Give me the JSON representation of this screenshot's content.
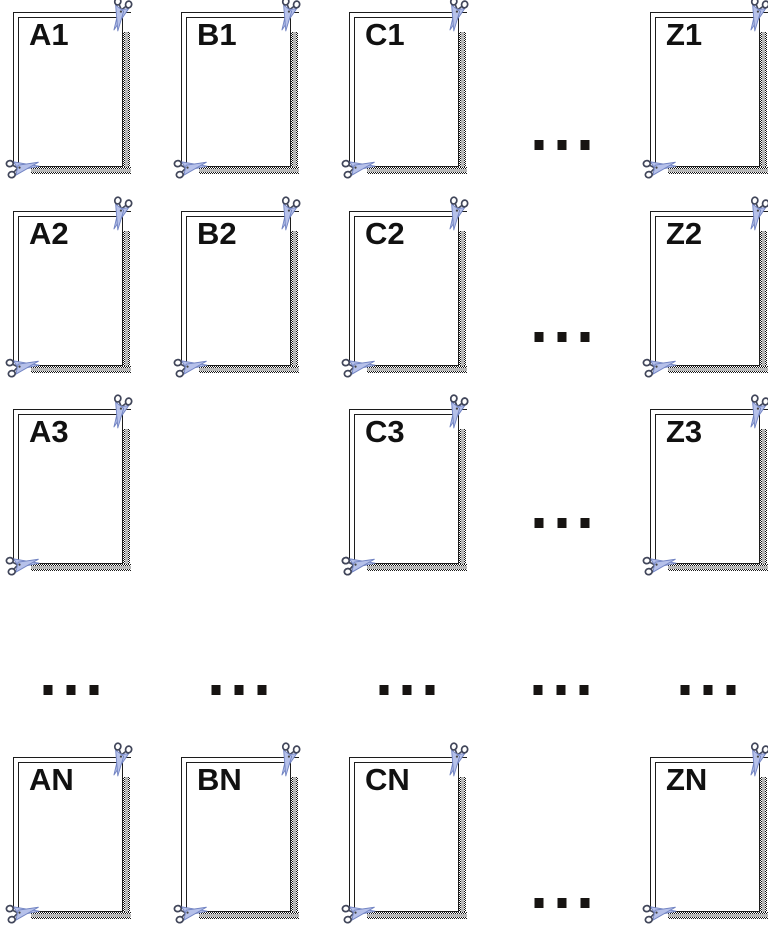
{
  "figure": {
    "title": "",
    "background": "#ffffff",
    "description": "Grid of cut-out coupon frames labeled by column letter (A, B, C, ..., Z) and row number (1, 2, 3, ..., N), each frame decorated with scissors cut-marks and a dotted shadow band"
  },
  "grid": {
    "cards": [
      {
        "label": "A1",
        "x": 13,
        "y": 12
      },
      {
        "label": "B1",
        "x": 181,
        "y": 12
      },
      {
        "label": "C1",
        "x": 349,
        "y": 12
      },
      {
        "label": "Z1",
        "x": 650,
        "y": 12
      },
      {
        "label": "A2",
        "x": 13,
        "y": 211
      },
      {
        "label": "B2",
        "x": 181,
        "y": 211
      },
      {
        "label": "C2",
        "x": 349,
        "y": 211
      },
      {
        "label": "Z2",
        "x": 650,
        "y": 211
      },
      {
        "label": "A3",
        "x": 13,
        "y": 409
      },
      {
        "label": "B3",
        "x": 349,
        "y": 409
      },
      {
        "label": "C3",
        "x": 349,
        "y": 409
      },
      {
        "label": "Z3",
        "x": 650,
        "y": 409
      },
      {
        "label": "AN",
        "x": 13,
        "y": 757
      },
      {
        "label": "BN",
        "x": 181,
        "y": 757
      },
      {
        "label": "CN",
        "x": 349,
        "y": 757
      },
      {
        "label": "ZN",
        "x": 650,
        "y": 757
      }
    ],
    "row_ellipses": [
      {
        "text": "...",
        "x": 562,
        "y": 145
      },
      {
        "text": "...",
        "x": 562,
        "y": 337
      },
      {
        "text": "...",
        "x": 562,
        "y": 523
      },
      {
        "text": "...",
        "x": 562,
        "y": 903
      }
    ],
    "column_ellipses": [
      {
        "text": "...",
        "x": 71,
        "y": 690
      },
      {
        "text": "...",
        "x": 239,
        "y": 690
      },
      {
        "text": "...",
        "x": 407,
        "y": 690
      },
      {
        "text": "...",
        "x": 561,
        "y": 690
      },
      {
        "text": "...",
        "x": 708,
        "y": 690
      }
    ]
  },
  "icons": {
    "scissors_top_right": "scissors-icon",
    "scissors_bottom_left": "scissors-icon"
  },
  "colors": {
    "border": "#1c1c1c",
    "label": "#111111",
    "shadow_center_gray": "#b7b7b7",
    "shadow_checker_dark": "#171717",
    "scissor_blade_fill": "#b6c1ea",
    "scissor_blade_stroke": "#7183c2",
    "scissor_handle_stroke": "#41465a",
    "background": "#ffffff"
  }
}
